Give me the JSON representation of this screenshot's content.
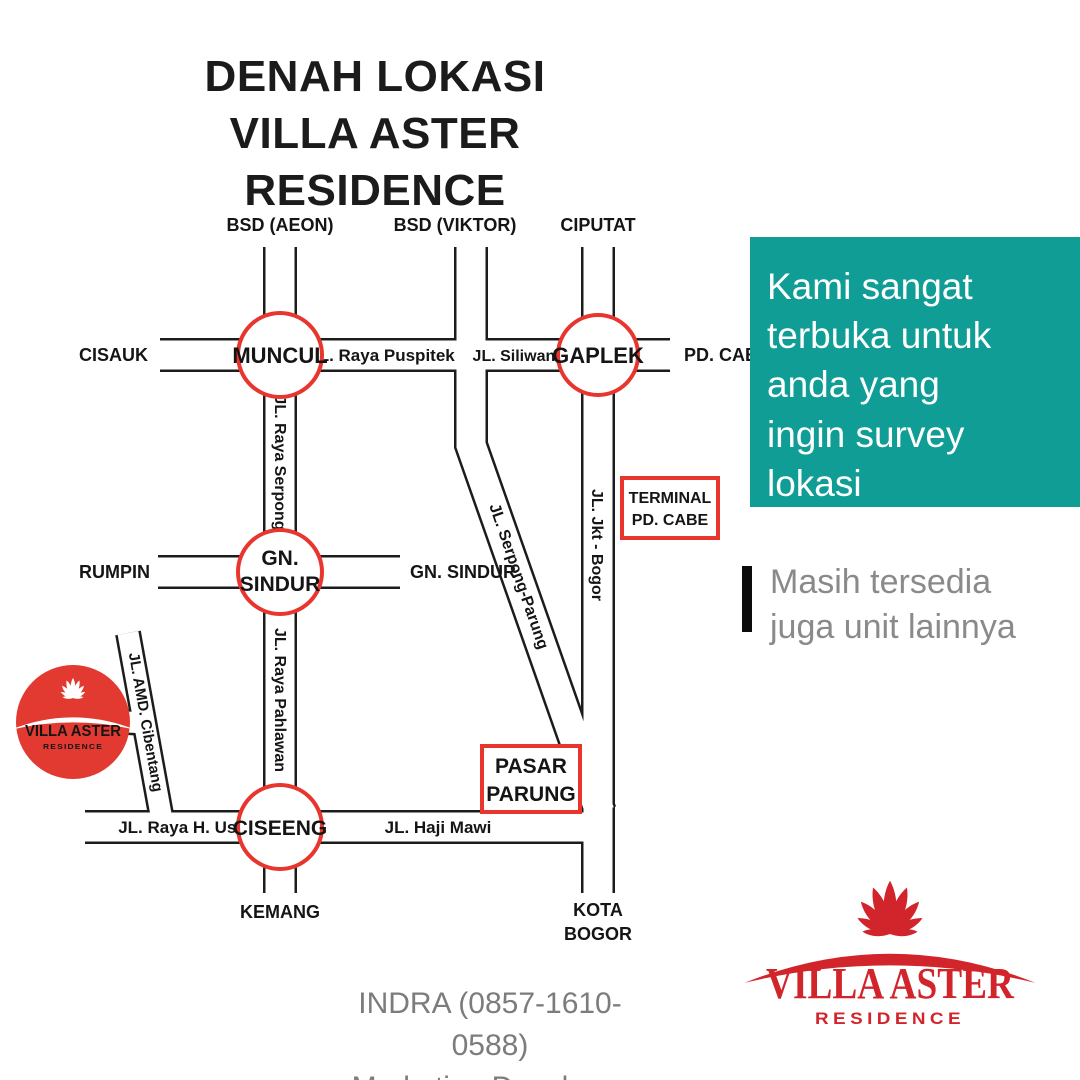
{
  "colors": {
    "teal_panel": "#0f9d95",
    "map_red": "#e8352e",
    "site_circle_red": "#e23a31",
    "brand_red": "#d2252b",
    "gray_text": "#8a8a8a",
    "road_line_black": "#1c1c1c"
  },
  "title": {
    "line1": "DENAH LOKASI",
    "line2": "VILLA ASTER RESIDENCE"
  },
  "map": {
    "destinations": {
      "bsd_aeon": "BSD (AEON)",
      "bsd_viktor": "BSD (VIKTOR)",
      "ciputat": "CIPUTAT",
      "cisauk": "CISAUK",
      "pd_cabe": "PD. CABE",
      "rumpin": "RUMPIN",
      "gn_sindur": "GN. SINDUR",
      "kemang": "KEMANG",
      "kota_bogor_1": "KOTA",
      "kota_bogor_2": "BOGOR"
    },
    "roundabouts": {
      "muncul": "MUNCUL",
      "gaplek": "GAPLEK",
      "gn_sindur_1": "GN.",
      "gn_sindur_2": "SINDUR",
      "ciseeng": "CISEENG"
    },
    "roads": {
      "puspitek": "JL. Raya Puspitek",
      "siliwangi": "JL. Siliwangi",
      "raya_serpong": "JL. Raya Serpong",
      "serpong_parung": "JL. Serpong-Parung",
      "jkt_bogor": "JL. Jkt - Bogor",
      "raya_pahlawan": "JL. Raya Pahlawan",
      "amd_cibentang": "JL. AMD. Cibentang",
      "raya_h_usa": "JL. Raya H. Usa",
      "haji_mawi": "JL. Haji Mawi"
    },
    "landmarks": {
      "terminal_1": "TERMINAL",
      "terminal_2": "PD. CABE",
      "pasar_1": "PASAR",
      "pasar_2": "PARUNG"
    },
    "site_logo": {
      "name": "VILLA ASTER",
      "sub": "RESIDENCE"
    }
  },
  "promo": {
    "lines": [
      "Kami sangat",
      "terbuka untuk",
      "anda yang",
      "ingin survey",
      "lokasi"
    ]
  },
  "availability": {
    "lines": [
      "Masih tersedia",
      "juga unit lainnya"
    ]
  },
  "contact": {
    "line1": "INDRA (0857-1610-0588)",
    "line2": "Marketing Developer"
  },
  "brand": {
    "name": "VILLA ASTER",
    "sub": "RESIDENCE"
  }
}
